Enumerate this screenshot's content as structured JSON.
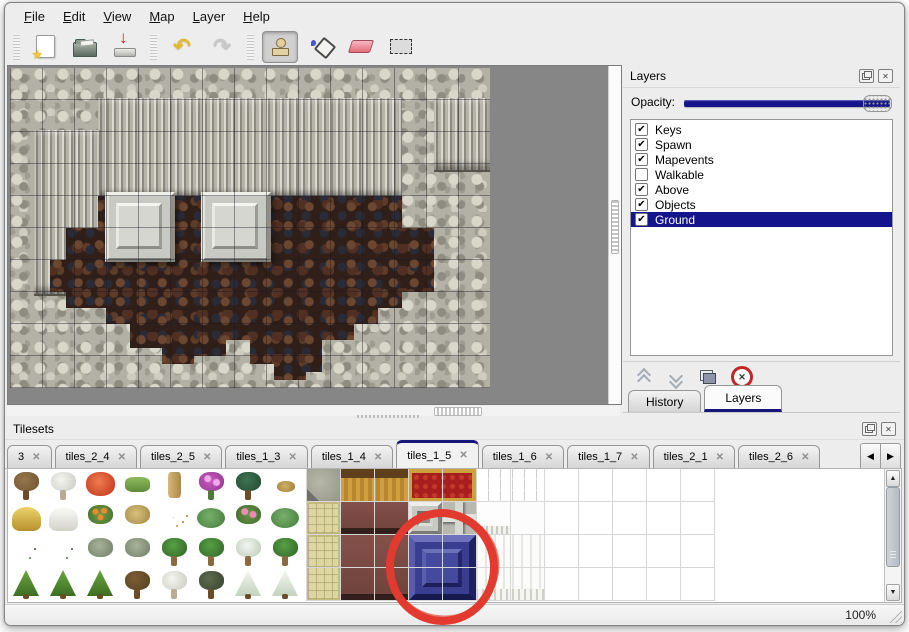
{
  "menu_bar": {
    "items": [
      {
        "label": "File"
      },
      {
        "label": "Edit"
      },
      {
        "label": "View"
      },
      {
        "label": "Map"
      },
      {
        "label": "Layer"
      },
      {
        "label": "Help"
      }
    ]
  },
  "toolbar": {
    "buttons": [
      {
        "icon": "new-file-icon",
        "selected": false
      },
      {
        "icon": "open-folder-icon",
        "selected": false
      },
      {
        "icon": "save-icon",
        "selected": false
      },
      {
        "icon": "undo-icon",
        "selected": false
      },
      {
        "icon": "redo-icon",
        "selected": false
      },
      {
        "icon": "stamp-tool-icon",
        "selected": true
      },
      {
        "icon": "fill-bucket-icon",
        "selected": false
      },
      {
        "icon": "eraser-icon",
        "selected": false
      },
      {
        "icon": "rect-select-icon",
        "selected": false
      }
    ]
  },
  "map_view": {
    "terrain": [
      "rock-wall",
      "cliff-face",
      "brown-rubble-floor"
    ],
    "pillar_count": 2,
    "grid_size_px": 32
  },
  "layers_panel": {
    "title": "Layers",
    "opacity_label": "Opacity:",
    "opacity_percent": 100,
    "layers": [
      {
        "label": "Keys",
        "checked": true,
        "selected": false
      },
      {
        "label": "Spawn",
        "checked": true,
        "selected": false
      },
      {
        "label": "Mapevents",
        "checked": true,
        "selected": false
      },
      {
        "label": "Walkable",
        "checked": false,
        "selected": false
      },
      {
        "label": "Above",
        "checked": true,
        "selected": false
      },
      {
        "label": "Objects",
        "checked": true,
        "selected": false
      },
      {
        "label": "Ground",
        "checked": true,
        "selected": true
      }
    ],
    "action_icons": [
      "raise-layer-icon",
      "lower-layer-icon",
      "duplicate-layer-icon",
      "delete-layer-icon"
    ],
    "bottom_tabs": [
      {
        "label": "History",
        "active": false
      },
      {
        "label": "Layers",
        "active": true
      }
    ]
  },
  "tilesets_panel": {
    "title": "Tilesets",
    "tabs": [
      {
        "label": "3",
        "active": false
      },
      {
        "label": "tiles_2_4",
        "active": false
      },
      {
        "label": "tiles_2_5",
        "active": false
      },
      {
        "label": "tiles_1_3",
        "active": false
      },
      {
        "label": "tiles_1_4",
        "active": false
      },
      {
        "label": "tiles_1_5",
        "active": true
      },
      {
        "label": "tiles_1_6",
        "active": false
      },
      {
        "label": "tiles_1_7",
        "active": false
      },
      {
        "label": "tiles_2_1",
        "active": false
      },
      {
        "label": "tiles_2_6",
        "active": false
      }
    ],
    "flora_tiles": [
      "tree-bare",
      "tree-bare-snow",
      "bloom-red",
      "stump-green",
      "trunk-tan",
      "bush-pink",
      "palm-dark",
      "sprout-tan",
      "mound-hay",
      "mound-snow",
      "flowers-orange",
      "bush-dry",
      "leaves-scatter",
      "lilypad",
      "bush-rose",
      "lilypad",
      "sprigs",
      "sprigs",
      "bush-gray",
      "bush-gray",
      "palm",
      "palm",
      "palm-snow",
      "palm",
      "pine-green",
      "pine-green",
      "pine-green",
      "tree-bare-dark",
      "tree-bare-snow",
      "tree-dark",
      "pine-snow",
      "pine-snow"
    ],
    "furniture_tiles": [
      {
        "col": 0,
        "row": 0,
        "w": 1,
        "h": 1,
        "type": "stone-corner"
      },
      {
        "col": 1,
        "row": 0,
        "w": 2,
        "h": 1,
        "type": "desk-gold"
      },
      {
        "col": 3,
        "row": 0,
        "w": 2,
        "h": 1,
        "type": "carpet-red"
      },
      {
        "col": 5,
        "row": 0,
        "w": 2,
        "h": 1,
        "type": "stone-gray"
      },
      {
        "col": 0,
        "row": 1,
        "w": 1,
        "h": 1,
        "type": "tatami"
      },
      {
        "col": 1,
        "row": 1,
        "w": 2,
        "h": 1,
        "type": "cloth-maroon"
      },
      {
        "col": 3,
        "row": 1,
        "w": 1,
        "h": 1,
        "type": "block-hollow"
      },
      {
        "col": 4,
        "row": 1,
        "w": 1,
        "h": 1,
        "type": "block-cross"
      },
      {
        "col": 5,
        "row": 1,
        "w": 1,
        "h": 1,
        "type": "fringe-white"
      },
      {
        "col": 6,
        "row": 1,
        "w": 1,
        "h": 1,
        "type": "tile-white"
      },
      {
        "col": 0,
        "row": 2,
        "w": 1,
        "h": 2,
        "type": "tatami"
      },
      {
        "col": 1,
        "row": 2,
        "w": 2,
        "h": 2,
        "type": "cloth-maroon"
      },
      {
        "col": 3,
        "row": 2,
        "w": 2,
        "h": 2,
        "type": "block-blue"
      },
      {
        "col": 5,
        "row": 2,
        "w": 2,
        "h": 2,
        "type": "curtain-white"
      }
    ],
    "annotation": {
      "shape": "red-circle",
      "color": "#e23a2e",
      "target": "blue-block-tile"
    }
  },
  "status_bar": {
    "zoom_level": "100%"
  },
  "icons": {
    "check_glyph": "✔",
    "tab_close_glyph": "✕",
    "delete_glyph": "✕",
    "close_glyph": "✕",
    "scroll_up_glyph": "▲",
    "scroll_down_glyph": "▼",
    "tab_prev_glyph": "◀",
    "tab_next_glyph": "▶"
  },
  "colors": {
    "selection_navy": "#14148c",
    "tab_accent_navy": "#16167a",
    "annotation_red": "#e23a2e",
    "canvas_gray": "#868686"
  }
}
